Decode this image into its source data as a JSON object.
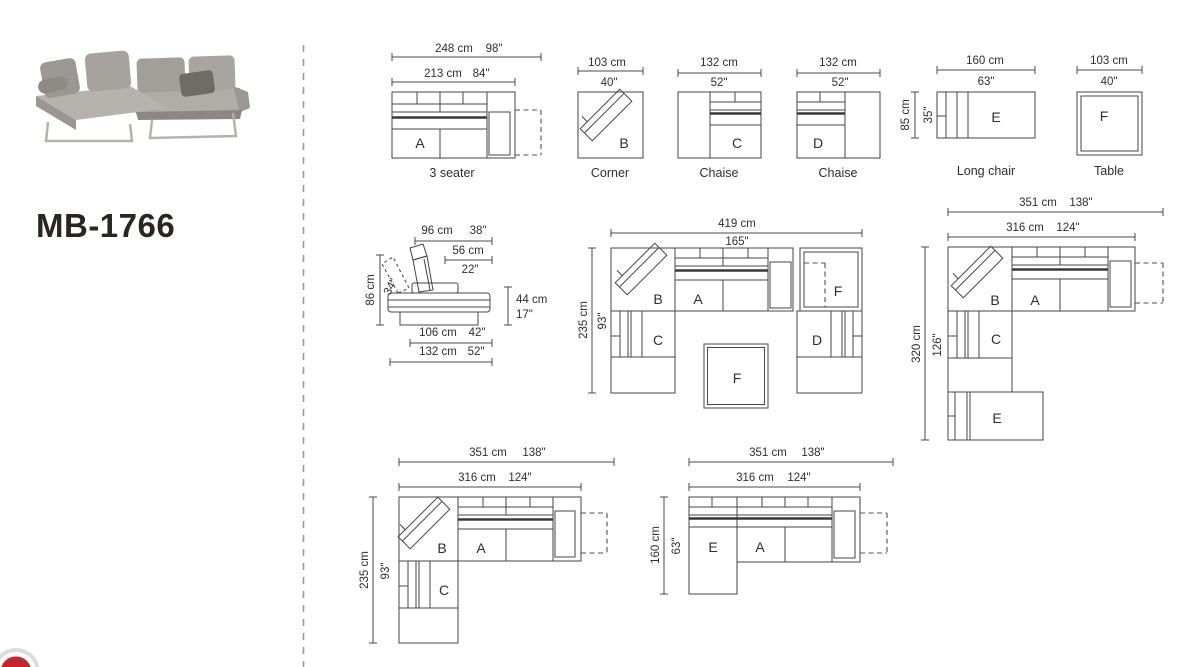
{
  "product": {
    "model": "MB-1766"
  },
  "units": {
    "a": {
      "letter": "A",
      "caption": "3 seater",
      "outer_cm": "248 cm",
      "outer_in": "98\"",
      "inner_cm": "213 cm",
      "inner_in": "84\""
    },
    "b": {
      "letter": "B",
      "caption": "Corner",
      "width_cm": "103 cm",
      "width_in": "40\""
    },
    "c": {
      "letter": "C",
      "caption": "Chaise",
      "width_cm": "132 cm",
      "width_in": "52\""
    },
    "d": {
      "letter": "D",
      "caption": "Chaise",
      "width_cm": "132 cm",
      "width_in": "52\""
    },
    "e": {
      "letter": "E",
      "caption": "Long chair",
      "width_cm": "160 cm",
      "width_in": "63\"",
      "depth_cm": "85 cm",
      "depth_in": "35\""
    },
    "f": {
      "letter": "F",
      "caption": "Table",
      "width_cm": "103 cm",
      "width_in": "40\""
    }
  },
  "side_view": {
    "back_width_cm": "96 cm",
    "back_width_in": "38\"",
    "seat_depth_cm": "56 cm",
    "seat_depth_in": "22\"",
    "height_cm": "86 cm",
    "back_angle_in": "34\"",
    "seat_height_cm": "44 cm",
    "seat_height_in": "17\"",
    "base_depth_cm": "106 cm",
    "base_depth_in": "42\"",
    "total_depth_cm": "132 cm",
    "total_depth_in": "52\""
  },
  "configurations": {
    "u_shape": {
      "width_cm": "419 cm",
      "width_in": "165\"",
      "depth_cm": "235 cm",
      "depth_in": "93\"",
      "labels": {
        "b": "B",
        "a": "A",
        "f_right": "F",
        "c": "C",
        "d": "D",
        "f_center": "F"
      }
    },
    "corner_with_longchair": {
      "width_cm": "351 cm",
      "width_in": "138\"",
      "inner_width_cm": "316 cm",
      "inner_width_in": "124\"",
      "depth_cm": "320 cm",
      "depth_in": "126\"",
      "labels": {
        "b": "B",
        "a": "A",
        "c": "C",
        "e": "E"
      }
    },
    "corner_chaise": {
      "width_cm": "351 cm",
      "width_in": "138\"",
      "inner_width_cm": "316 cm",
      "inner_width_in": "124\"",
      "depth_cm": "235 cm",
      "depth_in": "93\"",
      "labels": {
        "b": "B",
        "a": "A",
        "c": "C"
      }
    },
    "longchair_sofa": {
      "width_cm": "351 cm",
      "width_in": "138\"",
      "inner_width_cm": "316 cm",
      "inner_width_in": "124\"",
      "depth_cm": "160 cm",
      "depth_in": "63\"",
      "labels": {
        "e": "E",
        "a": "A"
      }
    }
  },
  "colors": {
    "line": "#454545",
    "accent_red": "#c2272d",
    "divider": "#9b9b9b"
  }
}
